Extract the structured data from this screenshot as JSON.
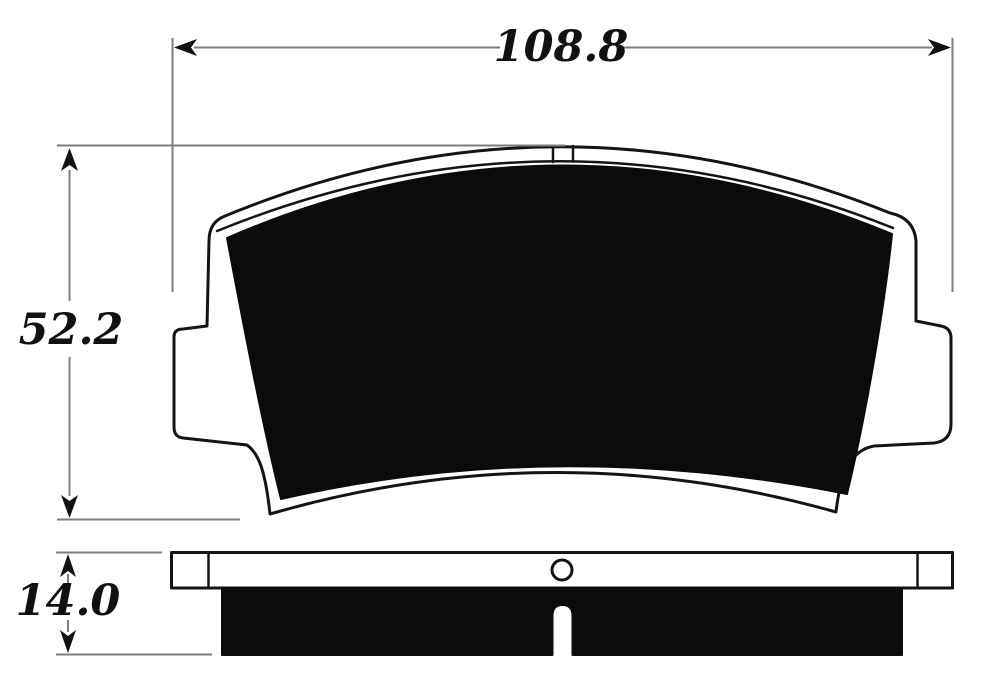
{
  "canvas": {
    "width": 991,
    "height": 682,
    "background": "#ffffff"
  },
  "labels": {
    "width": "108.8",
    "height": "52.2",
    "thickness": "14.0"
  },
  "colors": {
    "outline": "#141414",
    "friction_fill": "#0b0b0b",
    "dimension_line": "#7d7d7d",
    "label_text": "#111111"
  }
}
